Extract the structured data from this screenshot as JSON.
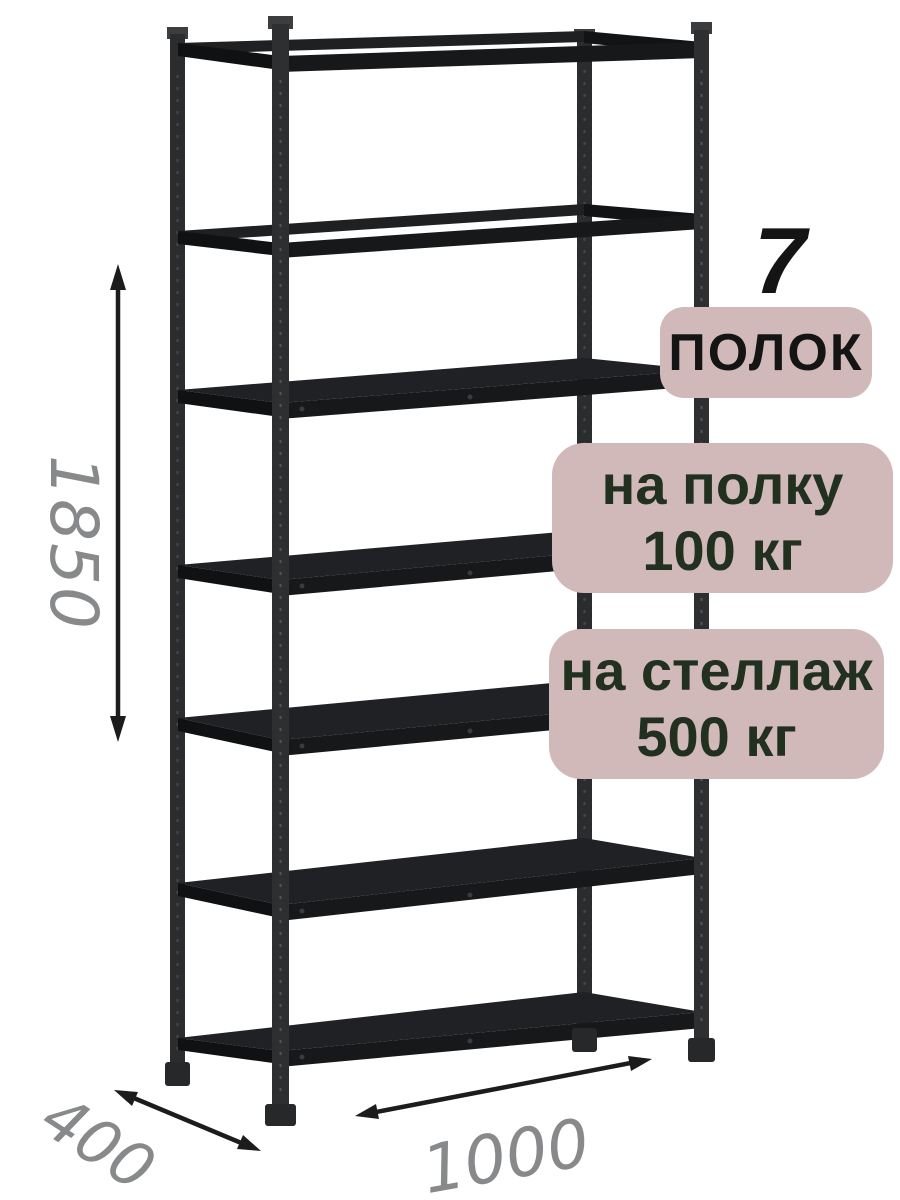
{
  "badges": {
    "shelf_count": {
      "number": "7",
      "label": "ПОЛОК"
    },
    "shelf_load": {
      "line1": "на полку",
      "line2": "100 кг"
    },
    "rack_load": {
      "line1": "на стеллаж",
      "line2": "500 кг"
    }
  },
  "dimensions": {
    "height": "1850",
    "depth": "400",
    "width": "1000"
  },
  "rack": {
    "shelf_count": 7
  },
  "colors": {
    "background": "#ffffff",
    "badge_background": "#d1b9ba",
    "badge_text": "#22301f",
    "headline_text": "#141414",
    "dimension_text": "#87898b",
    "rack_metal": "#2e2f31",
    "rack_panel": "#202124",
    "arrow": "#1c1c1c"
  }
}
